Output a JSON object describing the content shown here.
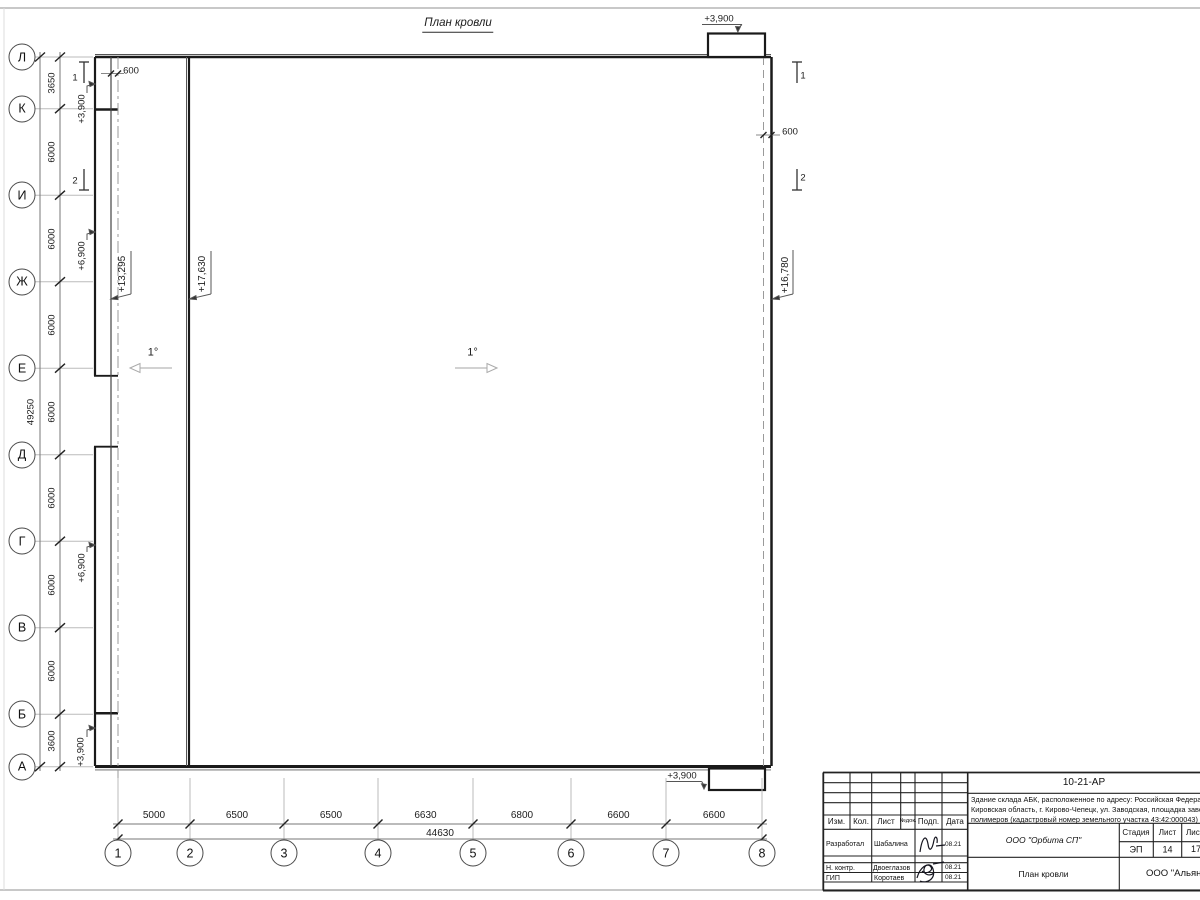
{
  "sheet": {
    "title": "План кровли",
    "slopes": {
      "left": "1°",
      "center": "1°"
    },
    "offsets": {
      "left": "600",
      "right": "600"
    },
    "elevations": {
      "canopy_top": "+3,900",
      "canopy_bottom": "+3,900",
      "left_top": "+3,900",
      "left_upper": "+6,900",
      "left_lower": "+6,900",
      "left_bottom": "+3,900",
      "roof_low": "+13,295",
      "roof_main": "+17,630",
      "roof_right": "+16,780"
    },
    "sections": {
      "s1": "1",
      "s2": "2"
    },
    "axes_rows": {
      "labels": [
        "Л",
        "К",
        "И",
        "Ж",
        "Е",
        "Д",
        "Г",
        "В",
        "Б",
        "А"
      ],
      "dims": [
        "3650",
        "6000",
        "6000",
        "6000",
        "6000",
        "6000",
        "6000",
        "6000",
        "3600"
      ],
      "total": "49250"
    },
    "axes_cols": {
      "labels": [
        "1",
        "2",
        "3",
        "4",
        "5",
        "6",
        "7",
        "8"
      ],
      "dims": [
        "5000",
        "6500",
        "6500",
        "6630",
        "6800",
        "6600",
        "6600"
      ],
      "total": "44630"
    }
  },
  "titleblock": {
    "code": "10-21-АР",
    "description": [
      "Здание склада АБК, расположенное по адресу: Российская Федерация,",
      "Кировская область, г. Кирово-Чепецк, ул. Заводская, площадка завода",
      "полимеров (кадастровый номер земельного участка 43:42:000043)"
    ],
    "rev_headers": [
      "Изм.",
      "Кол.",
      "Лист",
      "№док.",
      "Подп.",
      "Дата"
    ],
    "sign_rows": [
      [
        "Разработал",
        "Шабалина",
        "08.21"
      ],
      [
        "Н. контр.",
        "Двоеглазов",
        "08.21"
      ],
      [
        "ГИП",
        "Коротаев",
        "08.21"
      ]
    ],
    "company": "ООО \"Орбита СП\"",
    "stage_header": "Стадия",
    "sheet_header": "Лист",
    "sheets_header": "Листов",
    "stage": "ЭП",
    "sheet_no": "14",
    "sheets_total": "17",
    "doc_title": "План кровли",
    "org": "ООО \"Альянс\""
  }
}
